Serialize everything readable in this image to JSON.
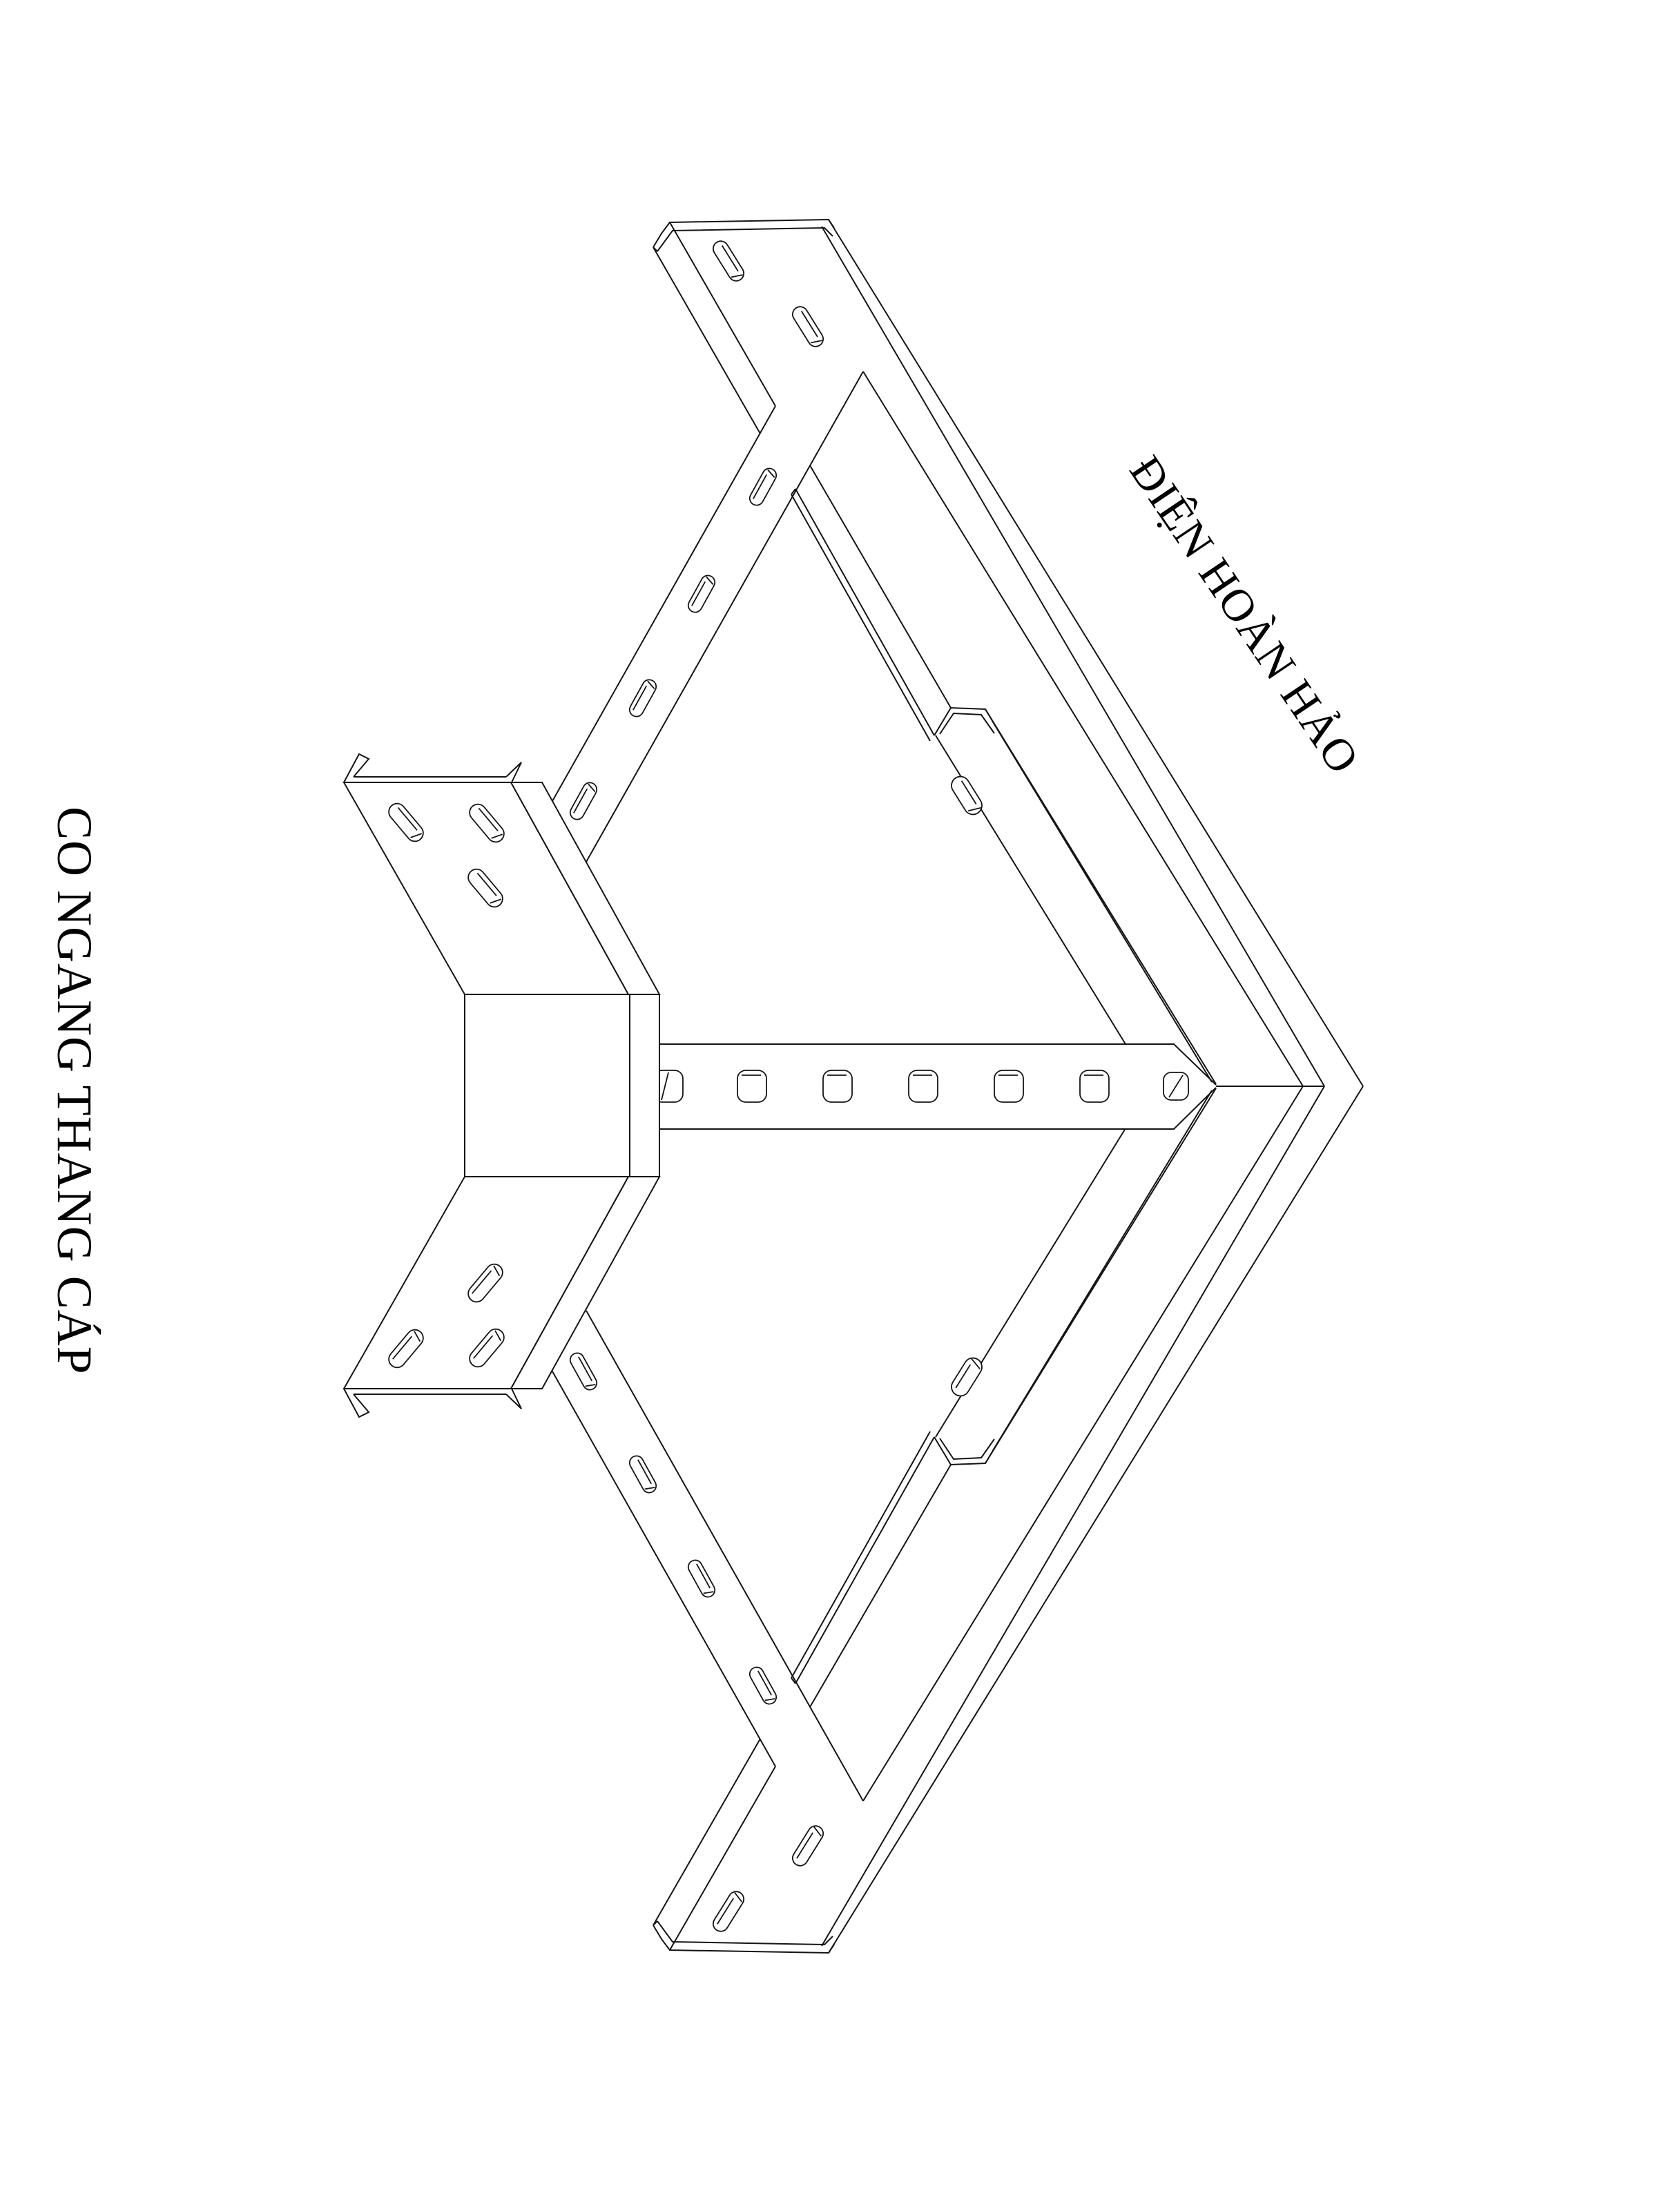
{
  "page": {
    "background_color": "#ffffff",
    "line_color": "#141414",
    "text_color": "#000000"
  },
  "labels": {
    "product_name": "CO NGANG THANG CÁP",
    "brand_name": "ĐIỆN HOÀN HẢO"
  }
}
